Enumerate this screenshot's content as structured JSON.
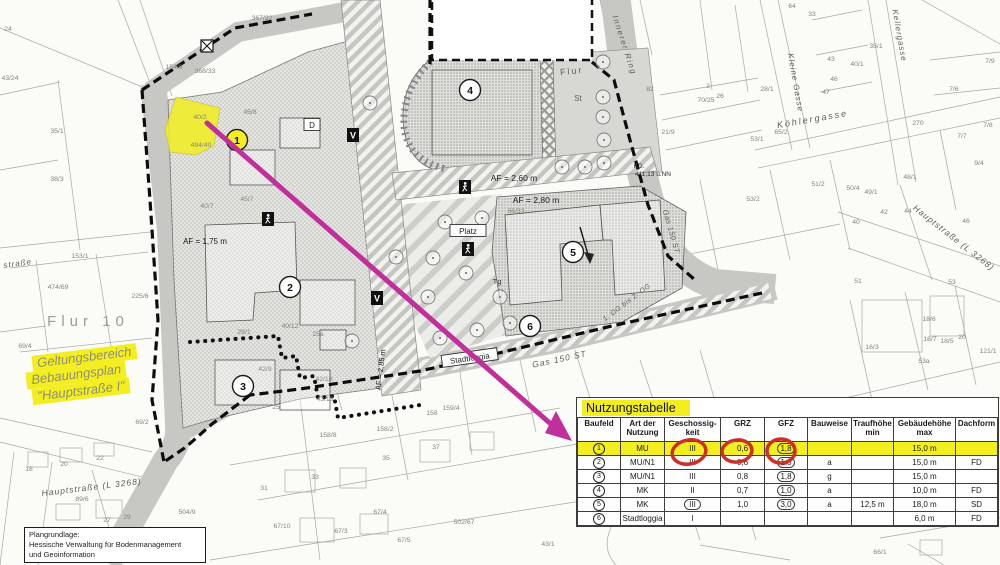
{
  "table": {
    "title": "Nutzungstabelle",
    "columns": [
      "Baufeld",
      "Art der\nNutzung",
      "Geschossig-\nkeit",
      "GRZ",
      "GFZ",
      "Bauweise",
      "Traufhöhe\nmin",
      "Gebäudehöhe\nmax",
      "Dachform"
    ],
    "col_widths": [
      43,
      44,
      56,
      44,
      43,
      44,
      42,
      62,
      42
    ],
    "rows": [
      {
        "baufeld": "1",
        "nutzung": "MU",
        "geschosse": "III",
        "grz": "0,6",
        "gfz": "1,8",
        "bauweise": "",
        "traufhoehe": "",
        "gebaeudehoehe": "15,0 m",
        "dachform": "",
        "highlight": true,
        "gfz_circled": true,
        "geschoss_circled": false
      },
      {
        "baufeld": "2",
        "nutzung": "MU/N1",
        "geschosse": "III",
        "grz": "0,6",
        "gfz": "1,8",
        "bauweise": "a",
        "traufhoehe": "",
        "gebaeudehoehe": "15,0 m",
        "dachform": "FD",
        "highlight": false,
        "gfz_circled": true,
        "geschoss_circled": false
      },
      {
        "baufeld": "3",
        "nutzung": "MU/N1",
        "geschosse": "III",
        "grz": "0,8",
        "gfz": "1,8",
        "bauweise": "g",
        "traufhoehe": "",
        "gebaeudehoehe": "15,0 m",
        "dachform": "",
        "highlight": false,
        "gfz_circled": true,
        "geschoss_circled": false
      },
      {
        "baufeld": "4",
        "nutzung": "MK",
        "geschosse": "II",
        "grz": "0,7",
        "gfz": "1,0",
        "bauweise": "a",
        "traufhoehe": "",
        "gebaeudehoehe": "10,0 m",
        "dachform": "FD",
        "highlight": false,
        "gfz_circled": true,
        "geschoss_circled": false
      },
      {
        "baufeld": "5",
        "nutzung": "MK",
        "geschosse": "III",
        "grz": "1,0",
        "gfz": "3,0",
        "bauweise": "a",
        "traufhoehe": "12,5 m",
        "gebaeudehoehe": "18,0 m",
        "dachform": "SD",
        "highlight": false,
        "gfz_circled": true,
        "geschoss_circled": true
      },
      {
        "baufeld": "6",
        "nutzung": "Stadtloggia",
        "geschosse": "I",
        "grz": "",
        "gfz": "",
        "bauweise": "",
        "traufhoehe": "",
        "gebaeudehoehe": "6,0 m",
        "dachform": "FD",
        "highlight": false,
        "gfz_circled": false,
        "geschoss_circled": false
      }
    ]
  },
  "plangrundlage": {
    "lines": [
      "Plangrundlage:",
      "Hessische Verwaltung für Bodenmanagement",
      "und Geoinformation"
    ]
  },
  "geltungsbereich": {
    "lines": [
      "Geltungsbereich",
      "Bebauungsplan",
      "\"Hauptstraße I\""
    ]
  },
  "annotations": {
    "arrow_color": "#c02f9c",
    "red_circle_color": "#cd2e28",
    "highlight_yellow": "#f3ee20",
    "red_circled_cells": [
      "Geschossigkeit III",
      "GRZ 0,6",
      "GFZ 1,8"
    ]
  },
  "map": {
    "street_labels": [
      {
        "t": "Innerer Ring",
        "x": 622,
        "y": 46,
        "r": 72,
        "s": 8,
        "ls": 1.5
      },
      {
        "t": "Kellergasse",
        "x": 897,
        "y": 36,
        "r": 80,
        "s": 8,
        "ls": 1
      },
      {
        "t": "Kleine Gasse",
        "x": 793,
        "y": 83,
        "r": 80,
        "s": 8,
        "ls": 1
      },
      {
        "t": "Köhlergasse",
        "x": 813,
        "y": 122,
        "r": -10,
        "s": 9,
        "ls": 2
      },
      {
        "t": "Hauptstraße (L 3268)",
        "x": 92,
        "y": 490,
        "r": -7,
        "s": 8.5,
        "ls": 1
      },
      {
        "t": "Hauptstraße (L 3268)",
        "x": 952,
        "y": 240,
        "r": 38,
        "s": 8.5,
        "ls": 1
      },
      {
        "t": "straße",
        "x": 18,
        "y": 266,
        "r": -8,
        "s": 8,
        "ls": 1
      },
      {
        "t": "Gas 150 ST",
        "x": 560,
        "y": 362,
        "r": -12,
        "s": 8.5,
        "ls": 1
      },
      {
        "t": "Gas 150 ST",
        "x": 669,
        "y": 232,
        "r": 74,
        "s": 7.5,
        "ls": 0.5
      },
      {
        "t": "1. OG bis 2. OG",
        "x": 628,
        "y": 304,
        "r": -37,
        "s": 7,
        "ls": 0.5
      }
    ],
    "area_labels": [
      {
        "t": "Flur 10",
        "x": 88,
        "y": 326,
        "s": 15,
        "c": "#9c9c96",
        "ls": 5
      },
      {
        "t": "Flur",
        "x": 572,
        "y": 74,
        "s": 9,
        "c": "#63635c",
        "r": -6,
        "ls": 2
      },
      {
        "t": "St",
        "x": 578,
        "y": 101,
        "s": 8,
        "c": "#63635c"
      },
      {
        "t": "Tg",
        "x": 497,
        "y": 284,
        "s": 7.5,
        "c": "#3d3d3a"
      },
      {
        "t": "AF = 1,75 m",
        "x": 205,
        "y": 244,
        "s": 8,
        "c": "#1e1e1e"
      },
      {
        "t": "AF = 2,60 m",
        "x": 514,
        "y": 181,
        "s": 8.5,
        "c": "#1e1e1e"
      },
      {
        "t": "AF = 2,80 m",
        "x": 536,
        "y": 203,
        "s": 8.5,
        "c": "#1e1e1e"
      },
      {
        "t": "AF = 2,85 m",
        "x": 383,
        "y": 370,
        "s": 7.5,
        "c": "#1e1e1e",
        "r": -83
      },
      {
        "t": "KD.",
        "x": 639,
        "y": 168,
        "s": 6.5,
        "c": "#2c2c2c"
      },
      {
        "t": "411,13 ü.NN",
        "x": 653,
        "y": 176,
        "s": 6.5,
        "c": "#2c2c2c"
      }
    ],
    "parcel_labels": [
      [
        "367/32",
        262,
        20
      ],
      [
        "368/33",
        205,
        73
      ],
      [
        "35/1",
        57,
        133
      ],
      [
        "38/3",
        57,
        181
      ],
      [
        "43/24",
        10,
        80
      ],
      [
        "24",
        8,
        31
      ],
      [
        "153/1",
        80,
        258
      ],
      [
        "474/69",
        58,
        289
      ],
      [
        "225/6",
        140,
        298
      ],
      [
        "69/4",
        25,
        348
      ],
      [
        "475/69 69/1",
        112,
        356
      ],
      [
        "69/2",
        142,
        424
      ],
      [
        "18",
        29,
        471
      ],
      [
        "20",
        64,
        466
      ],
      [
        "22",
        100,
        460
      ],
      [
        "89/6",
        82,
        501
      ],
      [
        "27",
        107,
        522
      ],
      [
        "29",
        127,
        519
      ],
      [
        "504/9",
        187,
        514
      ],
      [
        "154/9",
        174,
        69
      ],
      [
        "40/2",
        200,
        119
      ],
      [
        "494/40",
        201,
        147
      ],
      [
        "45/8",
        250,
        114
      ],
      [
        "45/7",
        247,
        201
      ],
      [
        "40/7",
        207,
        208
      ],
      [
        "40/12",
        290,
        328
      ],
      [
        "29/1",
        244,
        334
      ],
      [
        "25a",
        318,
        336
      ],
      [
        "42/9",
        265,
        371
      ],
      [
        "42/10",
        324,
        381
      ],
      [
        "25",
        276,
        409
      ],
      [
        "43/13",
        325,
        401
      ],
      [
        "158/8",
        328,
        437
      ],
      [
        "158/2",
        385,
        431
      ],
      [
        "159/4",
        451,
        410
      ],
      [
        "158",
        432,
        415
      ],
      [
        "31",
        264,
        490
      ],
      [
        "33",
        315,
        479
      ],
      [
        "35",
        386,
        460
      ],
      [
        "37",
        436,
        449
      ],
      [
        "67/10",
        282,
        528
      ],
      [
        "67/3",
        341,
        533
      ],
      [
        "67/4",
        380,
        514
      ],
      [
        "67/5",
        404,
        542
      ],
      [
        "502/67",
        464,
        524
      ],
      [
        "43/1",
        548,
        546
      ],
      [
        "66/33",
        516,
        213
      ],
      [
        "66/1",
        880,
        554
      ],
      [
        "82",
        650,
        91
      ],
      [
        "2",
        708,
        88
      ],
      [
        "26",
        720,
        98
      ],
      [
        "70/25",
        706,
        102
      ],
      [
        "21/9",
        668,
        134
      ],
      [
        "53/1",
        757,
        141
      ],
      [
        "53/2",
        753,
        201
      ],
      [
        "28/1",
        767,
        91
      ],
      [
        "64",
        792,
        8
      ],
      [
        "33",
        812,
        16
      ],
      [
        "43",
        831,
        61
      ],
      [
        "46",
        834,
        81
      ],
      [
        "47",
        826,
        94
      ],
      [
        "40/1",
        857,
        66
      ],
      [
        "35/1",
        876,
        48
      ],
      [
        "65/2",
        781,
        134
      ],
      [
        "270",
        918,
        125
      ],
      [
        "7/9",
        990,
        63
      ],
      [
        "7/6",
        954,
        91
      ],
      [
        "7/8",
        988,
        127
      ],
      [
        "7/7",
        962,
        138
      ],
      [
        "9/4",
        979,
        165
      ],
      [
        "48/1",
        910,
        179
      ],
      [
        "50/4",
        853,
        190
      ],
      [
        "49/1",
        871,
        194
      ],
      [
        "51/2",
        818,
        186
      ],
      [
        "51",
        858,
        283
      ],
      [
        "53",
        952,
        284
      ],
      [
        "42",
        884,
        214
      ],
      [
        "44",
        908,
        213
      ],
      [
        "46",
        966,
        223
      ],
      [
        "40",
        856,
        224
      ],
      [
        "16/3",
        872,
        349
      ],
      [
        "18/6",
        929,
        321
      ],
      [
        "18/7",
        930,
        341
      ],
      [
        "18/5",
        947,
        343
      ],
      [
        "20",
        962,
        339
      ],
      [
        "53a",
        924,
        363
      ],
      [
        "121/1",
        988,
        353
      ]
    ],
    "boxed_labels": [
      {
        "t": "Platz",
        "x": 468,
        "y": 233,
        "w": 30
      },
      {
        "t": "Stadtloggia",
        "x": 470,
        "y": 360,
        "w": 50,
        "r": -8
      },
      {
        "t": "D",
        "x": 312,
        "y": 127,
        "w": 10
      }
    ],
    "badges": [
      {
        "n": "1",
        "x": 237,
        "y": 140,
        "f": "#f3ee20"
      },
      {
        "n": "2",
        "x": 290,
        "y": 287,
        "f": "#ffffff"
      },
      {
        "n": "3",
        "x": 243,
        "y": 386,
        "f": "#ffffff"
      },
      {
        "n": "4",
        "x": 470,
        "y": 90,
        "f": "#ffffff"
      },
      {
        "n": "5",
        "x": 573,
        "y": 252,
        "f": "#ffffff"
      },
      {
        "n": "6",
        "x": 530,
        "y": 326,
        "f": "#ffffff"
      }
    ],
    "symbols": [
      {
        "k": "walk",
        "x": 268,
        "y": 219
      },
      {
        "k": "V",
        "x": 353,
        "y": 135
      },
      {
        "k": "V",
        "x": 377,
        "y": 298
      },
      {
        "k": "walk",
        "x": 465,
        "y": 187
      },
      {
        "k": "walk",
        "x": 468,
        "y": 249
      },
      {
        "k": "X",
        "x": 207,
        "y": 46
      }
    ],
    "trees": [
      [
        603,
        62
      ],
      [
        603,
        97
      ],
      [
        603,
        117
      ],
      [
        604,
        140
      ],
      [
        604,
        163
      ],
      [
        562,
        167
      ],
      [
        585,
        167
      ],
      [
        445,
        222
      ],
      [
        482,
        218
      ],
      [
        433,
        258
      ],
      [
        466,
        273
      ],
      [
        428,
        297
      ],
      [
        500,
        297
      ],
      [
        477,
        330
      ],
      [
        510,
        323
      ],
      [
        440,
        338
      ],
      [
        370,
        103
      ],
      [
        396,
        257
      ],
      [
        352,
        341
      ]
    ]
  }
}
